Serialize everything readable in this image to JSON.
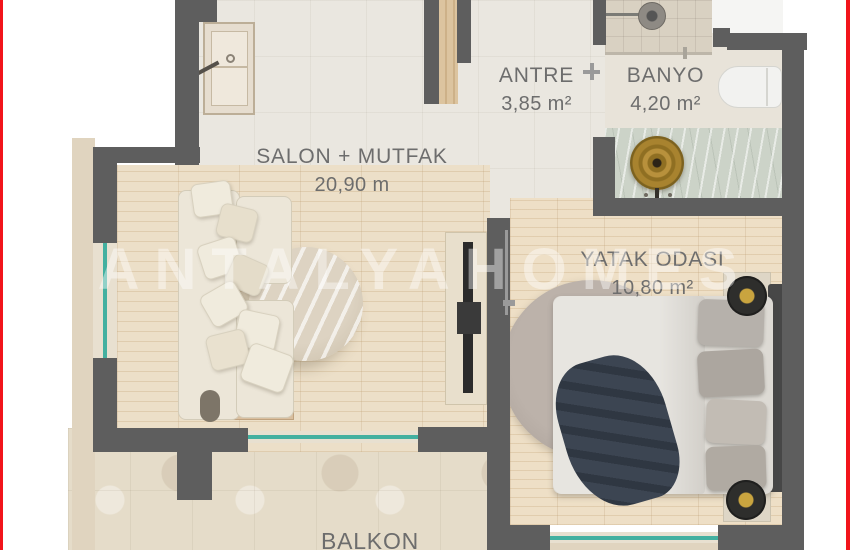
{
  "document": {
    "type": "apartment floor plan"
  },
  "rooms": {
    "salon": {
      "name": "SALON + MUTFAK",
      "area": "20,90 m"
    },
    "antre": {
      "name": "ANTRE",
      "area": "3,85 m²"
    },
    "banyo": {
      "name": "BANYO",
      "area": "4,20 m²"
    },
    "bedroom": {
      "name": "YATAK ODASI",
      "area": "10,80 m²"
    },
    "balcony": {
      "name": "BALKON"
    }
  },
  "watermark": {
    "text": "ANTALYAHOMES"
  },
  "palette": {
    "border_red": "#f2141b",
    "wall_gray": "#5e5e5e",
    "glass_teal": "#43b0a0",
    "label_gray": "#6d6d6d",
    "wood_floor": "#ecdfc8",
    "tile_floor": "#eae7e0",
    "balcony_stone": "#e5dcc9",
    "marble_counter": "#ccd3c8",
    "gold_fixture": "#b8913c",
    "navy_blanket": "#3c4552"
  }
}
